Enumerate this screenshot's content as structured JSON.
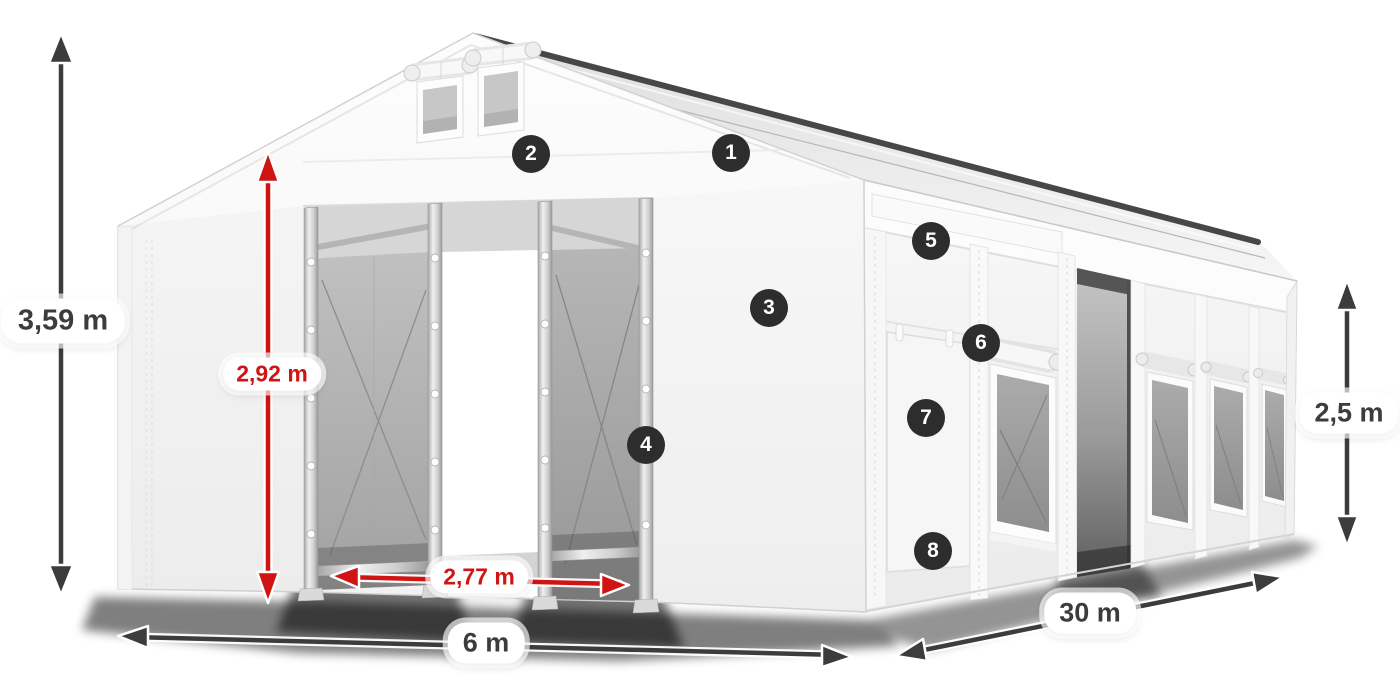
{
  "canvas": {
    "background": "#ffffff"
  },
  "colors": {
    "dimension_dark": "#3c3c3c",
    "dimension_red": "#d01313",
    "badge_background": "#2d2d2d",
    "badge_text": "#ffffff",
    "label_background": "#ffffff",
    "tent_white": "#f6f6f6",
    "mesh_gray": "#a8a8a8"
  },
  "diagram": {
    "subject": "white modular storage tent with open gable entrance, side door and mesh windows",
    "dimensions": [
      {
        "id": "total-height",
        "label": "3,59 m",
        "style": "dark",
        "orientation": "vertical"
      },
      {
        "id": "entrance-height",
        "label": "2,92 m",
        "style": "red",
        "orientation": "vertical"
      },
      {
        "id": "entrance-width",
        "label": "2,77 m",
        "style": "red",
        "orientation": "horizontal"
      },
      {
        "id": "gable-width",
        "label": "6 m",
        "style": "dark",
        "orientation": "horizontal"
      },
      {
        "id": "length",
        "label": "30 m",
        "style": "dark",
        "orientation": "diagonal"
      },
      {
        "id": "side-height",
        "label": "2,5 m",
        "style": "dark",
        "orientation": "vertical"
      }
    ],
    "markers": [
      {
        "number": "1"
      },
      {
        "number": "2"
      },
      {
        "number": "3"
      },
      {
        "number": "4"
      },
      {
        "number": "5"
      },
      {
        "number": "6"
      },
      {
        "number": "7"
      },
      {
        "number": "8"
      }
    ]
  }
}
